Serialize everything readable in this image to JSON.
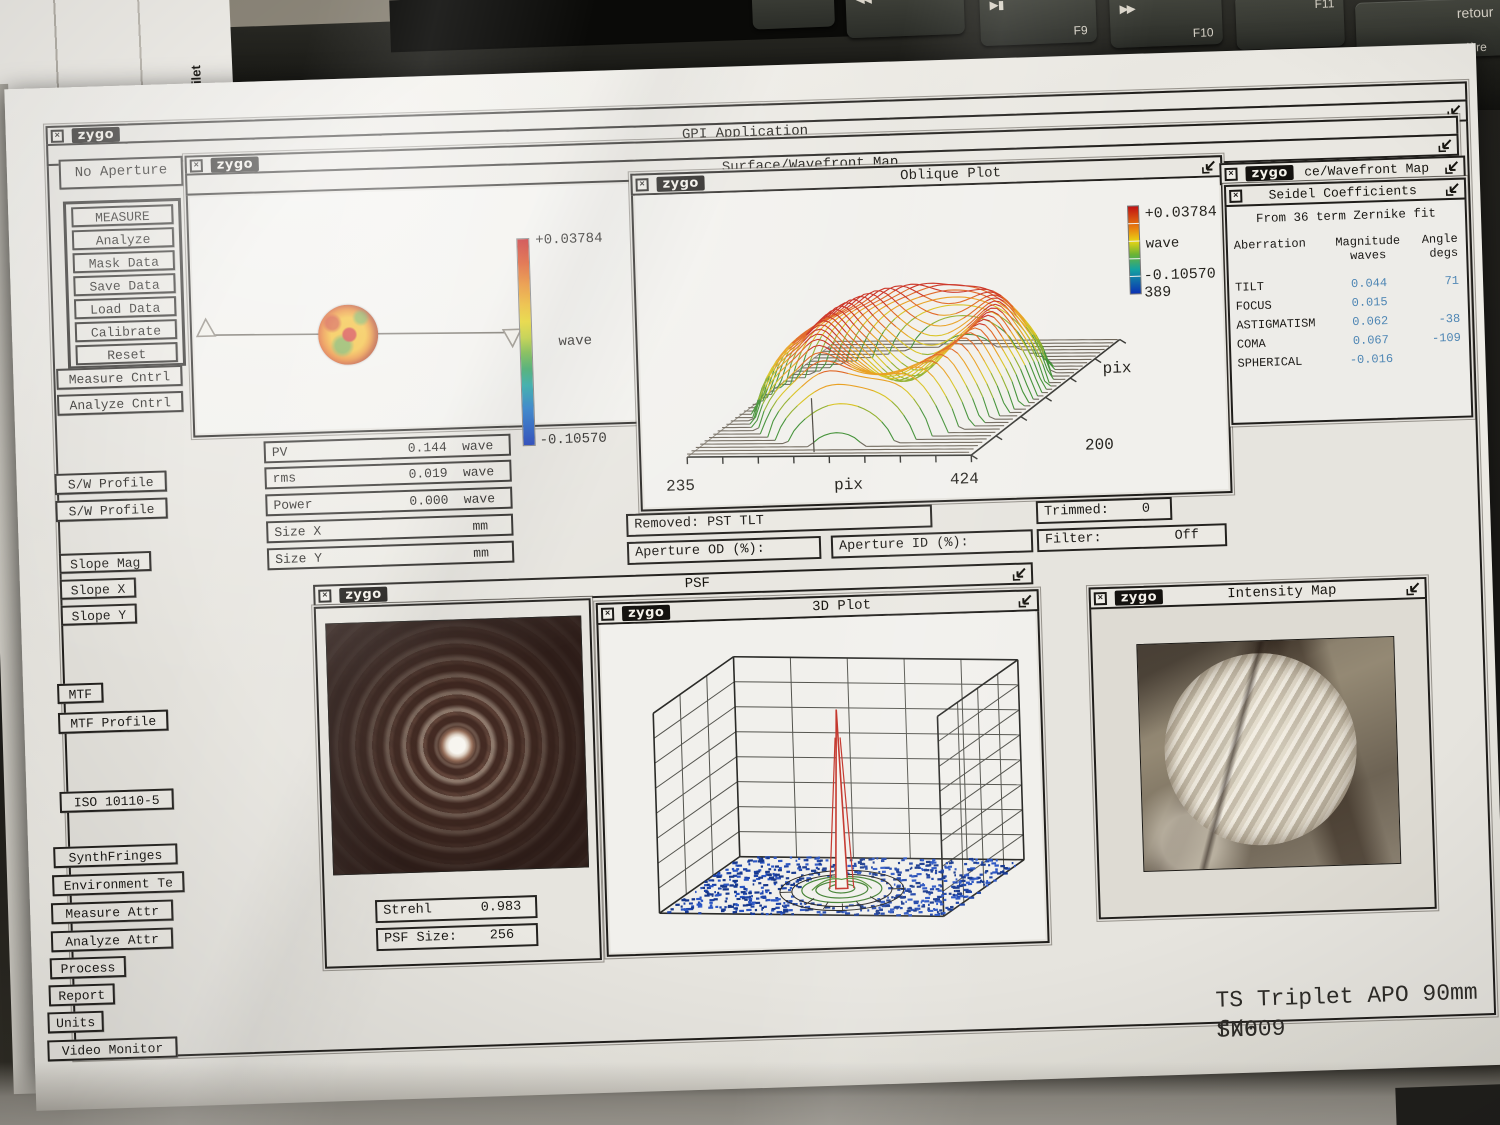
{
  "keyboard": {
    "keys": [
      {
        "icon": "◀◀",
        "sub": ""
      },
      {
        "icon": "▶▮",
        "sub": "F9"
      },
      {
        "icon": "▶▶",
        "sub": "F10"
      },
      {
        "icon": "",
        "sub": "F11"
      },
      {
        "icon": "retour",
        "sub": "arrière"
      }
    ]
  },
  "backdrop": {
    "side_paper_text": "eau filet"
  },
  "app": {
    "logo": "zygo",
    "title": "GPI Application"
  },
  "sidebar": {
    "aperture_button": "No Aperture",
    "measure_group": [
      "MEASURE",
      "Analyze",
      "Mask Data",
      "Save Data",
      "Load Data",
      "Calibrate",
      "Reset"
    ],
    "cntrl_buttons": [
      "Measure Cntrl",
      "Analyze Cntrl"
    ],
    "profile_buttons": [
      "S/W Profile",
      "S/W Profile"
    ],
    "slope_buttons": [
      "Slope Mag",
      "Slope X",
      "Slope Y"
    ],
    "mtf_buttons": [
      "MTF",
      "MTF Profile"
    ],
    "iso_button": "ISO 10110-5",
    "tool_buttons": [
      "SynthFringes",
      "Environment Te",
      "Measure Attr",
      "Analyze Attr",
      "Process",
      "Report",
      "Units",
      "Video Monitor"
    ]
  },
  "wavefront_map": {
    "title": "Surface/Wavefront Map",
    "scale_max": "+0.03784",
    "scale_unit": "wave",
    "scale_min": "-0.10570"
  },
  "stats": {
    "rows": [
      {
        "label": "PV",
        "value": "0.144",
        "unit": "wave"
      },
      {
        "label": "rms",
        "value": "0.019",
        "unit": "wave"
      },
      {
        "label": "Power",
        "value": "0.000",
        "unit": "wave"
      },
      {
        "label": "Size X",
        "value": "",
        "unit": "mm"
      },
      {
        "label": "Size Y",
        "value": "",
        "unit": "mm"
      }
    ]
  },
  "oblique": {
    "title": "Oblique Plot",
    "scale_max": "+0.03784",
    "scale_unit": "wave",
    "scale_min": "-0.10570",
    "points_label": "389",
    "x_min": "235",
    "x_label": "pix",
    "x_max": "424",
    "depth_label": "pix",
    "depth_max": "200"
  },
  "process_row": {
    "removed_label": "Removed:",
    "removed_value": "PST TLT",
    "trimmed_label": "Trimmed:",
    "trimmed_value": "0",
    "aperture_od_label": "Aperture OD (%):",
    "aperture_id_label": "Aperture ID (%):",
    "filter_label": "Filter:",
    "filter_value": "Off"
  },
  "seidel": {
    "behind_title": "ce/Wavefront Map",
    "title": "Seidel Coefficients",
    "subtitle": "From 36 term Zernike fit",
    "columns": {
      "c1": "Aberration",
      "c2a": "Magnitude",
      "c2b": "waves",
      "c3a": "Angle",
      "c3b": "degs"
    },
    "rows": [
      {
        "name": "TILT",
        "magnitude": "0.044",
        "angle": "71"
      },
      {
        "name": "FOCUS",
        "magnitude": "0.015",
        "angle": ""
      },
      {
        "name": "ASTIGMATISM",
        "magnitude": "0.062",
        "angle": "-38"
      },
      {
        "name": "COMA",
        "magnitude": "0.067",
        "angle": "-109"
      },
      {
        "name": "SPHERICAL",
        "magnitude": "-0.016",
        "angle": ""
      }
    ],
    "value_color": "#4e86b4"
  },
  "psf": {
    "title": "PSF",
    "strehl_label": "Strehl",
    "strehl_value": "0.983",
    "size_label": "PSF Size:",
    "size_value": "256"
  },
  "plot3d": {
    "title": "3D Plot"
  },
  "intensity": {
    "title": "Intensity Map"
  },
  "annotation": {
    "line1": "TS Triplet APO 90mm f/6",
    "line2": "SN009"
  }
}
